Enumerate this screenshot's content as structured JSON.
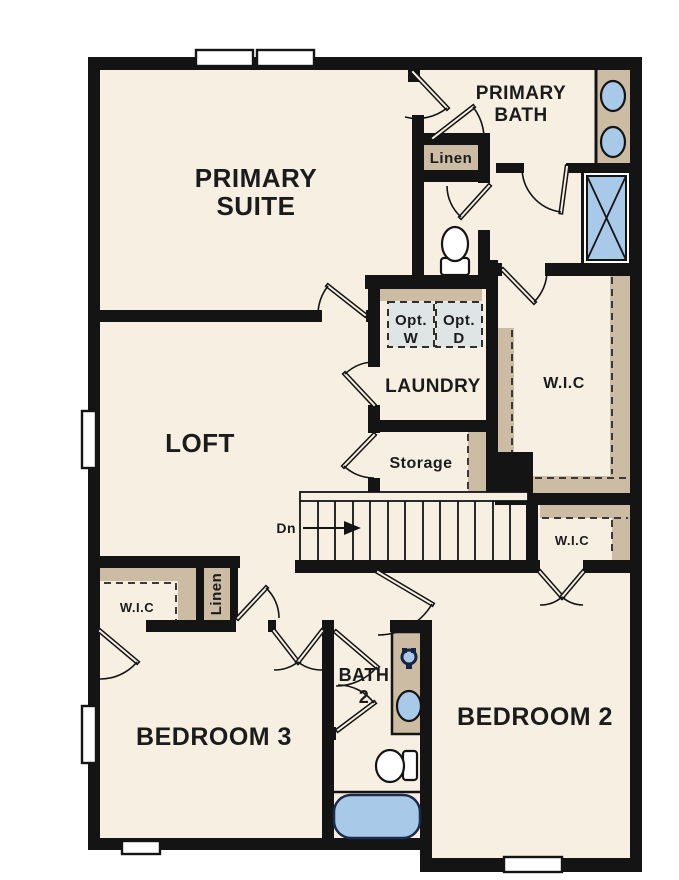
{
  "plan": {
    "rooms": {
      "primary_suite": {
        "line1": "PRIMARY",
        "line2": "SUITE"
      },
      "primary_bath": {
        "line1": "PRIMARY",
        "line2": "BATH"
      },
      "loft": {
        "label": "LOFT"
      },
      "laundry": {
        "label": "LAUNDRY"
      },
      "storage": {
        "label": "Storage"
      },
      "bath2": {
        "line1": "BATH",
        "line2": "2"
      },
      "bedroom2": {
        "label": "BEDROOM 2"
      },
      "bedroom3": {
        "label": "BEDROOM 3"
      }
    },
    "closets": {
      "linen_upper": {
        "label": "Linen"
      },
      "linen_lower": {
        "label": "Linen"
      },
      "wic_primary": {
        "label": "W.I.C"
      },
      "wic_hall": {
        "label": "W.I.C"
      },
      "wic_bedroom3": {
        "label": "W.I.C"
      }
    },
    "stairs": {
      "direction_label": "Dn"
    },
    "appliances": {
      "washer": {
        "line1": "Opt.",
        "line2": "W"
      },
      "dryer": {
        "line1": "Opt.",
        "line2": "D"
      }
    },
    "colors": {
      "floor": "#f7efe1",
      "wall": "#141414",
      "cabinetry": "#cbbca3",
      "fixtures": "#a9c9e9",
      "appliance_fill": "#dfe4e5"
    }
  }
}
